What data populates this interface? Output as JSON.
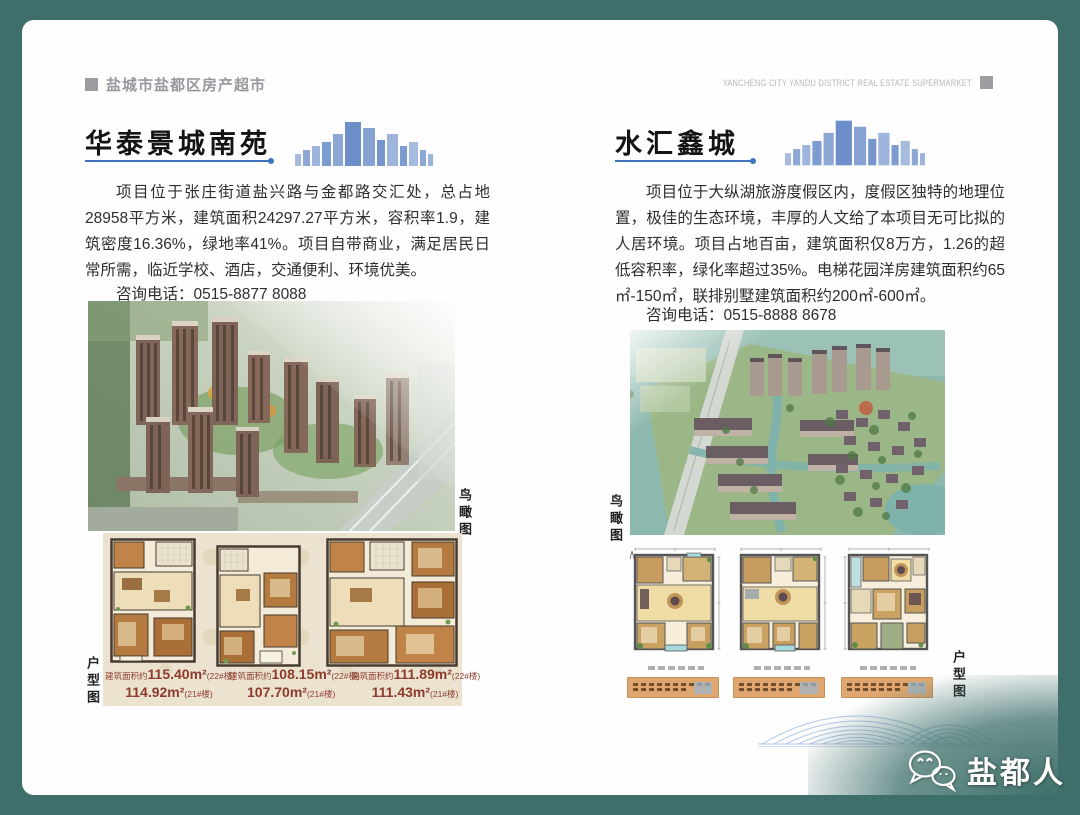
{
  "colors": {
    "brand_teal": "#3E6F6A",
    "accent_blue": "#3F74BD",
    "header_gray": "#96989D",
    "caption_red": "#8E3B2E",
    "panel_beige": "#EBE3D0",
    "caption_box_orange": "#DFA76F"
  },
  "header": {
    "title_zh": "盐城市盐都区房产超市",
    "title_en": "YANCHENG CITY YANDU DISTRICT REAL ESTATE SUPERMARKET"
  },
  "watermark": {
    "icon": "wechat-icon",
    "label": "盐都人"
  },
  "listings": [
    {
      "name": "华泰景城南苑",
      "description": "项目位于张庄街道盐兴路与金都路交汇处，总占地28958平方米，建筑面积24297.27平方米，容积率1.9，建筑密度16.36%，绿地率41%。项目自带商业，满足居民日常所需，临近学校、酒店，交通便利、环境优美。",
      "phone_label": "咨询电话：",
      "phone_number": "0515-8877 8088",
      "aerial_label": "鸟瞰图",
      "floorplan_label": "户型图",
      "floorplan_captions": [
        {
          "prefix": "建筑面积约",
          "area_a": "115.40m²",
          "unit_a": "(22#楼)",
          "area_b": "114.92m²",
          "unit_b": "(21#楼)"
        },
        {
          "prefix": "建筑面积约",
          "area_a": "108.15m²",
          "unit_a": "(22#楼)",
          "area_b": "107.70m²",
          "unit_b": "(21#楼)"
        },
        {
          "prefix": "建筑面积约",
          "area_a": "111.89m²",
          "unit_a": "(22#楼)",
          "area_b": "111.43m²",
          "unit_b": "(21#楼)"
        }
      ]
    },
    {
      "name": "水汇鑫城",
      "description": "项目位于大纵湖旅游度假区内，度假区独特的地理位置，极佳的生态环境，丰厚的人文给了本项目无可比拟的人居环境。项目占地百亩，建筑面积仅8万方，1.26的超低容积率，绿化率超过35%。电梯花园洋房建筑面积约65㎡-150㎡，联排别墅建筑面积约200㎡-600㎡。",
      "phone_label": "咨询电话：",
      "phone_number": "0515-8888 8678",
      "aerial_label": "鸟瞰图",
      "floorplan_label": "户型图"
    }
  ]
}
